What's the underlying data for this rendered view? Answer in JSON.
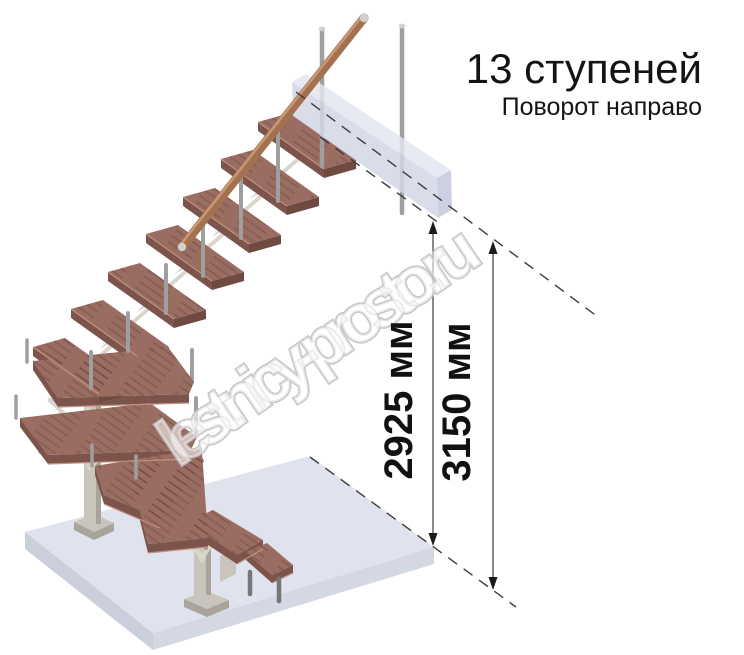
{
  "title": {
    "steps": "13 ступеней",
    "turn": "Поворот направо"
  },
  "dimensions": {
    "height_to_landing": "2925 мм",
    "height_total": "3150 мм"
  },
  "watermark": {
    "text": "lestnicy-prosto.ru"
  },
  "illustration": {
    "description": "3D render of a modular staircase with right turn, 13 steps, wooden treads, metal balusters, wooden handrail, floor slab and upper landing with height dimension lines"
  },
  "colors": {
    "tread_top": "#9a6d62",
    "tread_front": "#7d544c",
    "tread_end": "#6f4a43",
    "tread_edge": "#c1937f",
    "handrail": "#a3714f",
    "handrail_light": "#cf9f79",
    "metal": "#9f9f9f",
    "metal_dark": "#767676",
    "metal_cap": "#d0d0d0",
    "column": "#c9c5bc",
    "column_shade": "#a9a49b",
    "bracket": "#d9d5cd",
    "floor_top": "#e0e3ed",
    "floor_left": "#cbcfdc",
    "floor_right": "#d4d8e3",
    "box_front": "#d3d8e7",
    "box_top": "#e3e6f1",
    "box_end": "#c3c9db",
    "dash_line": "#3c3c3c",
    "dim_line": "#4a4a4a",
    "text": "#141414",
    "watermark_outline": "#c2c2c2"
  }
}
